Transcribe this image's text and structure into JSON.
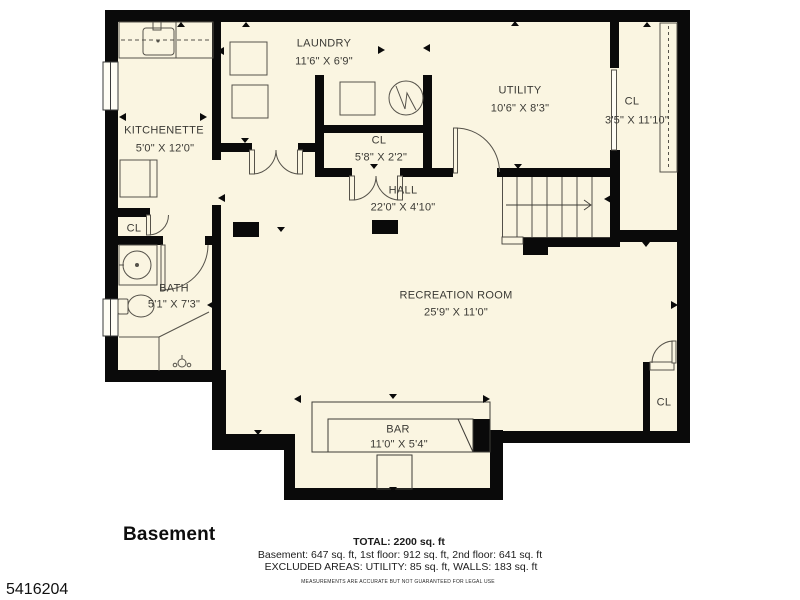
{
  "title": "Basement floor plan",
  "rooms": {
    "laundry": {
      "name": "LAUNDRY",
      "dims": "11'6\" X 6'9\""
    },
    "kitchenette": {
      "name": "KITCHENETTE",
      "dims": "5'0\" X 12'0\""
    },
    "utility": {
      "name": "UTILITY",
      "dims": "10'6\" X 8'3\""
    },
    "closet_right": {
      "name": "CL",
      "dims": "3'5\" X 11'10\""
    },
    "closet_hall": {
      "name": "CL",
      "dims": "5'8\" X 2'2\""
    },
    "hall": {
      "name": "HALL",
      "dims": "22'0\" X 4'10\""
    },
    "bath": {
      "name": "BATH",
      "dims": "5'1\" X 7'3\""
    },
    "recreation": {
      "name": "RECREATION ROOM",
      "dims": "25'9\" X 11'0\""
    },
    "bar": {
      "name": "BAR",
      "dims": "11'0\" X 5'4\""
    },
    "closet_nook": {
      "name": "CL"
    },
    "closet_rec": {
      "name": "CL"
    }
  },
  "footer": {
    "floor_label": "Basement",
    "total": "TOTAL: 2200 sq. ft",
    "breakdown": "Basement: 647 sq. ft, 1st floor: 912 sq. ft, 2nd floor: 641 sq. ft",
    "excluded": "EXCLUDED AREAS: UTILITY: 85 sq. ft, WALLS: 183 sq. ft",
    "disclaimer": "MEASUREMENTS ARE ACCURATE BUT NOT GUARANTEED FOR LEGAL USE"
  },
  "watermark": {
    "id": "5416204"
  },
  "colors": {
    "floor": "#faf5e1",
    "wall": "#0a0a0a",
    "line": "#55524a",
    "text": "#3b3a35"
  }
}
